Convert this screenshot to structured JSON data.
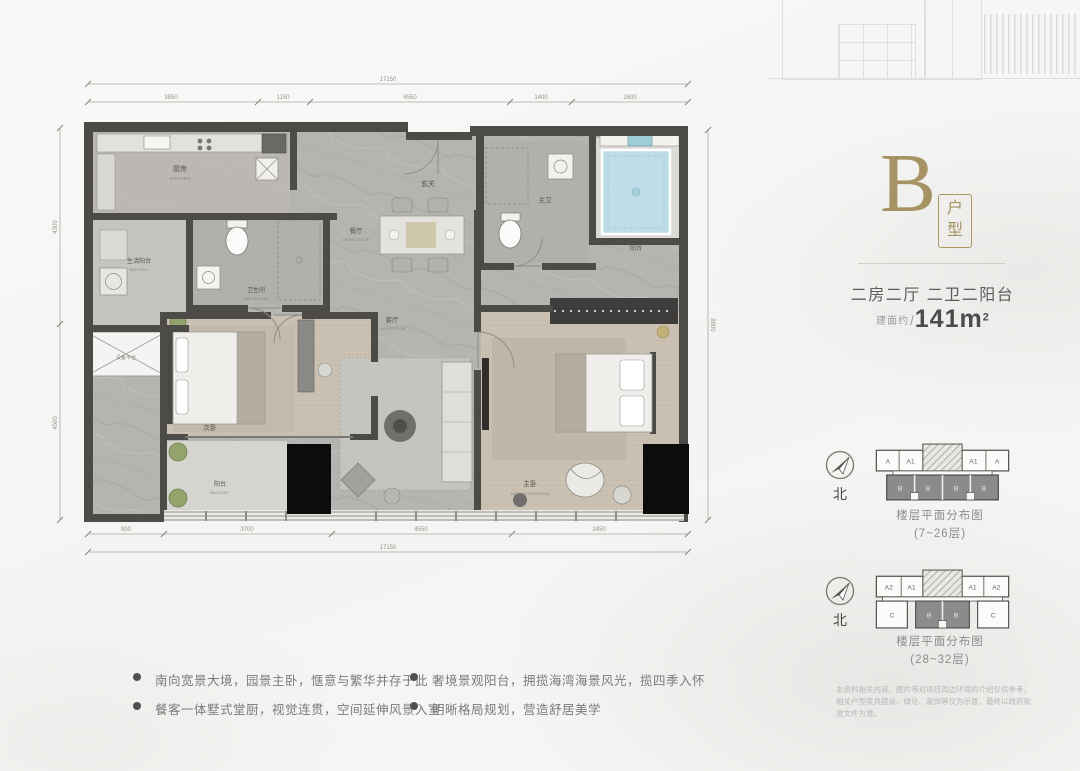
{
  "colors": {
    "accent_gold": "#a69263",
    "wall": "#4c4b48",
    "text_dark": "#4c4c4a",
    "tub_blue": "#bedde8"
  },
  "header": {
    "type_letter": "B",
    "type_box": "户型",
    "layout": "二房二厅 二卫二阳台",
    "area_label": "建面约",
    "area_slash": "/",
    "area_value": "141m",
    "area_sup": "2"
  },
  "plan": {
    "rooms": {
      "foyer": {
        "zh": "玄关"
      },
      "kitchen": {
        "zh": "厨房",
        "en": "KITCHEN"
      },
      "service_balcony": {
        "zh": "生活阳台",
        "en": "BALCONY"
      },
      "equipment": {
        "zh": "设备平台"
      },
      "bath1": {
        "zh": "卫生间",
        "en": "BATHROOM"
      },
      "bedroom1": {
        "zh": "次卧",
        "en": "BEDROOM"
      },
      "balcony1": {
        "zh": "阳台",
        "en": "BALCONY"
      },
      "dining": {
        "zh": "餐厅",
        "en": "DINING ROOM"
      },
      "living": {
        "zh": "客厅",
        "en": "LIVING ROOM"
      },
      "master_bath": {
        "zh": "主卫",
        "en": "M.BATH"
      },
      "balcony2": {
        "zh": "阳台",
        "en": "BALCONY"
      },
      "master_bedroom": {
        "zh": "主卧",
        "en": "MASTER BEDROOM"
      }
    },
    "dims": {
      "top_total": "17150",
      "top_segments": [
        "3850",
        "1150",
        "4550",
        "1400",
        "2600"
      ],
      "bottom_total": "17150",
      "bottom_segments": [
        "900",
        "3700",
        "4550",
        "2450"
      ],
      "left_segments": [
        "4300",
        "4500"
      ],
      "right_total": "8800"
    }
  },
  "distribution": [
    {
      "north": "北",
      "caption": "楼层平面分布图",
      "range": "(7~26层)",
      "top_cells": [
        "A",
        "A1",
        "A1",
        "A"
      ],
      "bottom_cells": [
        "B",
        "B",
        "B",
        "B"
      ]
    },
    {
      "north": "北",
      "caption": "楼层平面分布图",
      "range": "(28~32层)",
      "top_cells": [
        "A2",
        "A1",
        "A1",
        "A2"
      ],
      "bottom_cells": [
        "C",
        "B",
        "B",
        "C"
      ]
    }
  ],
  "features": [
    "南向宽景大境，园景主卧，惬意与繁华并存于此",
    "餐客一体墅式堂厨，视觉连贯，空间延伸风景入室",
    "奢境景观阳台，拥揽海湾海景风光，揽四季入怀",
    "明晰格局规划，营造舒居美学"
  ],
  "disclaimer": [
    "本资料相关内容、图片等对项目周边环境的介绍仅供参考；",
    "相关户型家具摆设、绿化、装饰等仅为示意，最终以政府批准文件为准。"
  ]
}
